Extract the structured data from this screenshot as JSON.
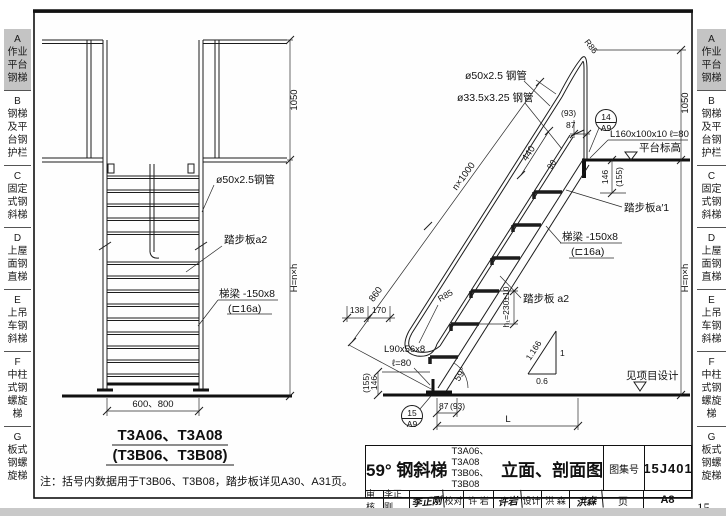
{
  "page": {
    "number": "15"
  },
  "sidebar": {
    "tabs": [
      {
        "label": "A\n作业\n平台\n钢梯",
        "active": true
      },
      {
        "label": "B\n钢梯\n及平\n台钢\n护栏",
        "active": false
      },
      {
        "label": "C\n固定\n式钢\n斜梯",
        "active": false
      },
      {
        "label": "D\n上屋\n面钢\n直梯",
        "active": false
      },
      {
        "label": "E\n上吊\n车钢\n斜梯",
        "active": false
      },
      {
        "label": "F\n中柱\n式钢\n螺旋\n梯",
        "active": false
      },
      {
        "label": "G\n板式\n钢螺\n旋梯",
        "active": false
      }
    ]
  },
  "left_view": {
    "dim_1050": "1050",
    "dim_height": "H=n×h",
    "label_rail_pipe": "ø50x2.5钢管",
    "label_tread": "踏步板a2",
    "label_stringer_line1": "梯梁 -150x8",
    "label_stringer_line2": "(⊏16a)",
    "dim_width": "600、800",
    "caption_line1": "T3A06、T3A08",
    "caption_line2": "(T3B06、T3B08)"
  },
  "right_view": {
    "label_rail_pipe": "ø50x2.5 钢管",
    "label_mid_rail_pipe": "ø33.5x3.25 钢管",
    "label_radius_top": "R85",
    "label_radius_bottom": "R85",
    "dim_top_offset_paren": "(93)",
    "dim_top_offset": "87",
    "detail_top_num": "14",
    "detail_top_page": "A9",
    "label_top_angle": "L160x100x10 ℓ=80",
    "label_platform_level": "平台标高",
    "dim_first_rise": "146",
    "dim_first_rise_paren": "(155)",
    "label_top_tread": "踏步板a′1",
    "dim_flights": "n×1000",
    "dim_bottom_flight": "860",
    "dim_rail_space": "440",
    "dim_rail_offset": "90",
    "label_stringer_line1": "梯梁 -150x8",
    "label_stringer_line2": "(⊏16a)",
    "label_tread": "踏步板 a2",
    "dim_run": "138",
    "dim_run2": "170",
    "dim_rise": "h₁=230±10",
    "label_base_angle_line1": "L90x56x8",
    "label_base_angle_line2": "ℓ=80",
    "dim_base_rise": "146",
    "dim_base_rise_paren": "(155)",
    "dim_angle": "59°",
    "dim_base_offset": "87",
    "dim_base_offset_paren": "(93)",
    "dim_length": "L",
    "slope_hypotenuse": "1.166",
    "slope_rise": "1",
    "slope_run": "0.6",
    "detail_bottom_num": "15",
    "detail_bottom_page": "A9",
    "label_ground_level": "见项目设计",
    "dim_1050": "1050",
    "dim_height": "H=n×h"
  },
  "note": "注：括号内数据用于T3B06、T3B08，踏步板详见A30、A31页。",
  "title_block": {
    "title_prefix": "59° 钢斜梯",
    "title_models": "T3A06、T3A08\nT3B06、T3B08",
    "title_suffix": "立面、剖面图",
    "atlas_label": "图集号",
    "atlas_no": "15J401",
    "page_label": "页",
    "page_no": "A8",
    "review_label": "审核",
    "review_name": "李正刚",
    "review_sign": "李正刚",
    "proof_label": "校对",
    "proof_name": "许 岩",
    "proof_sign": "许岩",
    "design_label": "设计",
    "design_name": "洪 森",
    "design_sign": "洪森"
  }
}
